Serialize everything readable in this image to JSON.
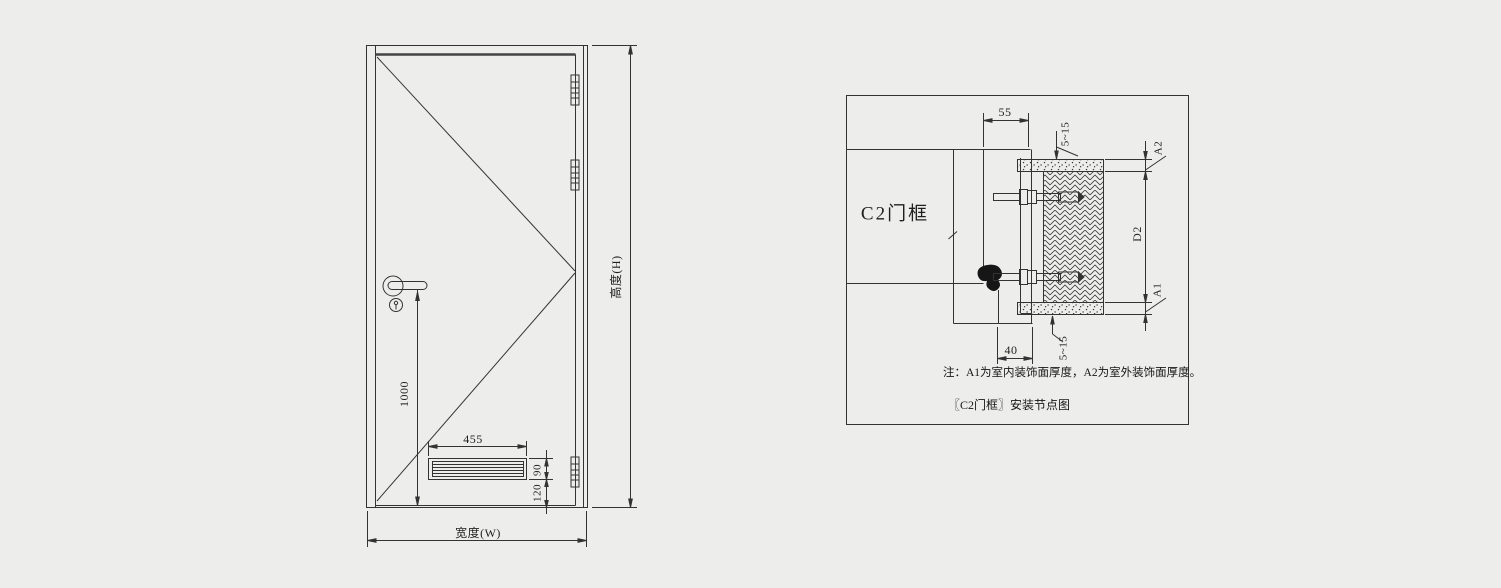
{
  "page": {
    "background": "#edeeec",
    "ink": "#333333"
  },
  "door_elevation": {
    "width_label": "宽度(W)",
    "height_label": "高度(H)",
    "handle_height_dim": "1000",
    "louver": {
      "width_dim": "455",
      "height_dim": "90",
      "bottom_offset_dim": "120"
    }
  },
  "frame_detail": {
    "frame_label": "C2门框",
    "frame_face_dim": "55",
    "top_gap_dim": "5~15",
    "outside_finish_dim": "A2",
    "wall_thickness_dim": "D2",
    "inside_finish_dim": "A1",
    "bottom_gap_dim": "5~15",
    "frame_depth_dim": "40",
    "note": "注：A1为室内装饰面厚度，A2为室外装饰面厚度。",
    "caption": "〖C2门框〗安装节点图"
  }
}
